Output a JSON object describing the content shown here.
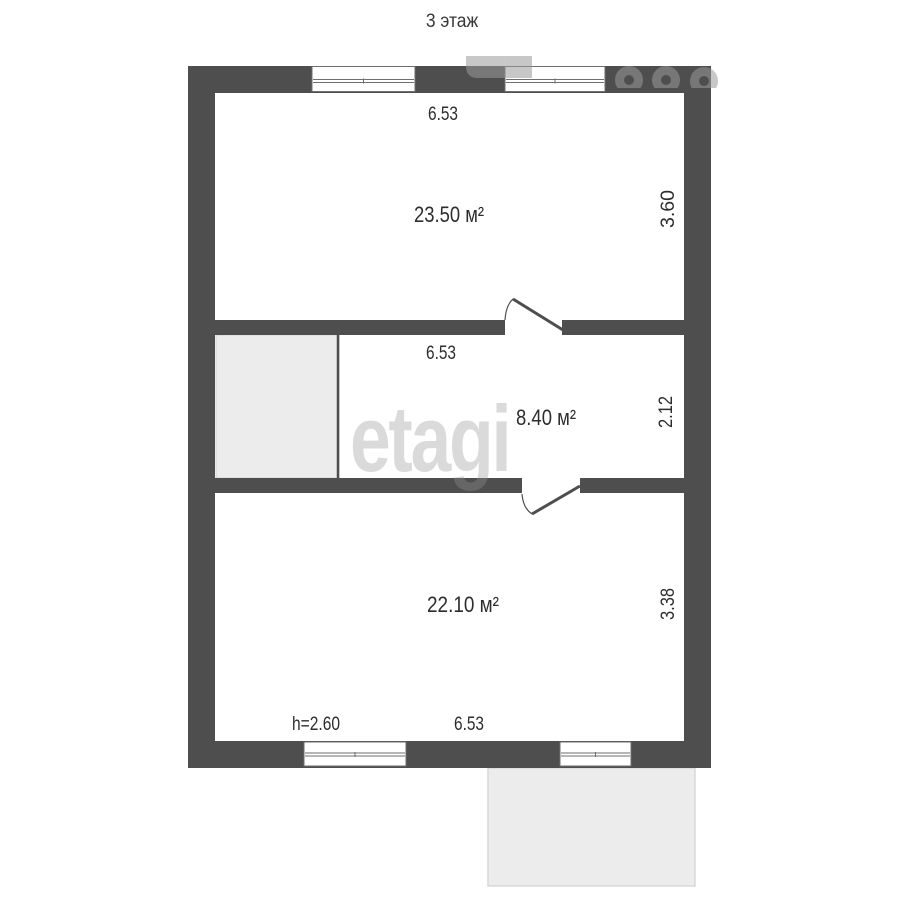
{
  "floor_plan": {
    "title": "3 этаж",
    "watermark": "etagi",
    "colors": {
      "wall": "#4e4e4e",
      "room_fill": "#ffffff",
      "annex_fill": "#ececec",
      "watermark_gray": "#9a9a9a",
      "label_text": "#2d2d2d"
    },
    "rooms": [
      {
        "id": "room-top",
        "area": "23.50 м²",
        "width": "6.53",
        "depth": "3.60"
      },
      {
        "id": "room-middle",
        "area": "8.40 м²",
        "width": "6.53",
        "depth": "2.12"
      },
      {
        "id": "room-bottom",
        "area": "22.10 м²",
        "width": "6.53",
        "depth": "3.38",
        "ceiling_height": "h=2.60"
      }
    ]
  }
}
